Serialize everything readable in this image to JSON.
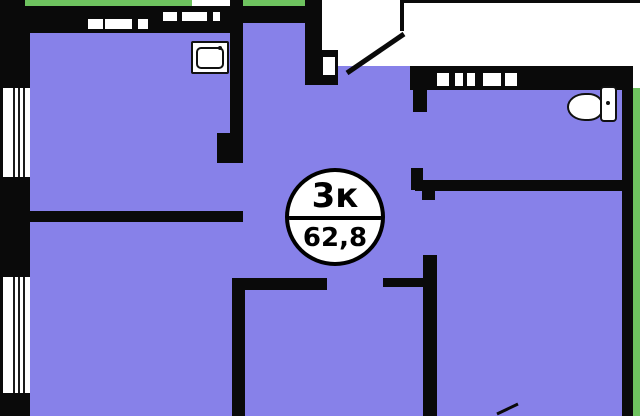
{
  "plan": {
    "badge": {
      "rooms": "3к",
      "total_area": "62,8"
    },
    "rooms": {
      "kitchen": {
        "label": "кухня",
        "area": "8,9"
      },
      "corridor": {
        "label": "",
        "area": "9,5"
      },
      "hallway": {
        "label": "прихожая",
        "area": ""
      },
      "bathroom": {
        "label": "санузел",
        "area": "4,7"
      },
      "living": {
        "label": "жилая комната",
        "area": ""
      },
      "bedroom_mid": {
        "label": "спальня",
        "area": ""
      },
      "bedroom_right": {
        "label": "спальня",
        "area": "11,0"
      }
    },
    "icons": {
      "sink": "kitchen-sink-icon",
      "toilet": "toilet-icon",
      "windows": "window-icon",
      "doors": "door-swing-icon"
    },
    "colors": {
      "room_fill": "#8781e9",
      "wall": "#0a0a0a",
      "balcony_green": "#6ec25f",
      "label_text": "#241d55"
    }
  }
}
